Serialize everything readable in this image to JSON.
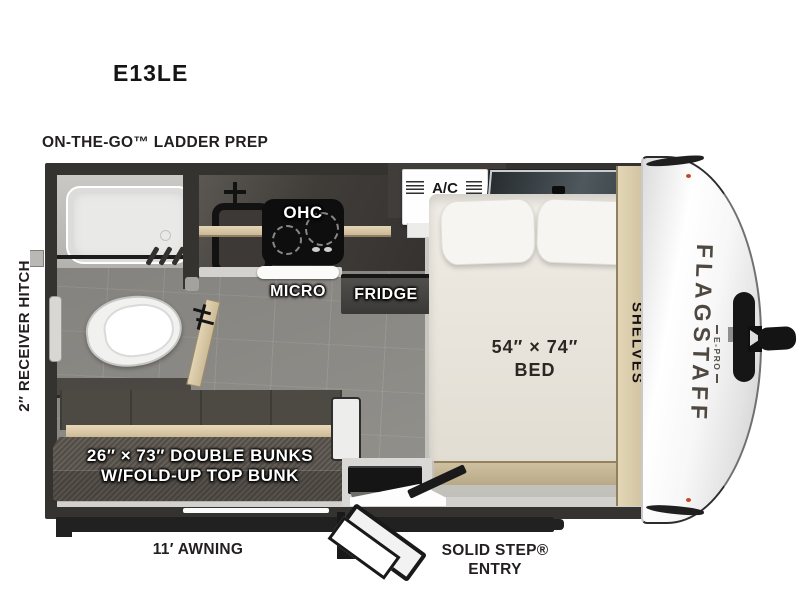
{
  "model": "E13LE",
  "exterior": {
    "ladder_prep": "ON-THE-GO™ LADDER PREP",
    "receiver_hitch": "2″ RECEIVER HITCH",
    "awning": "11′ AWNING",
    "solid_step": "SOLID STEP®",
    "entry": "ENTRY"
  },
  "interior": {
    "ohc": "OHC",
    "micro": "MICRO",
    "fridge": "FRIDGE",
    "ac": "A/C",
    "bed_size": "54″ × 74″",
    "bed": "BED",
    "shelves": "SHELVES",
    "bunks_size": "26″ × 73″ DOUBLE BUNKS",
    "bunks_note": "W/FOLD-UP TOP BUNK"
  },
  "brand": {
    "name": "FLAGSTAFF",
    "series": "E-PRO"
  },
  "colors": {
    "wall": "#35332f",
    "wood": "#d8c7a5",
    "floor": "#908e89",
    "bunk_fabric": "#5b554e",
    "marker_light": "#c24a28",
    "text": "#231f20"
  }
}
